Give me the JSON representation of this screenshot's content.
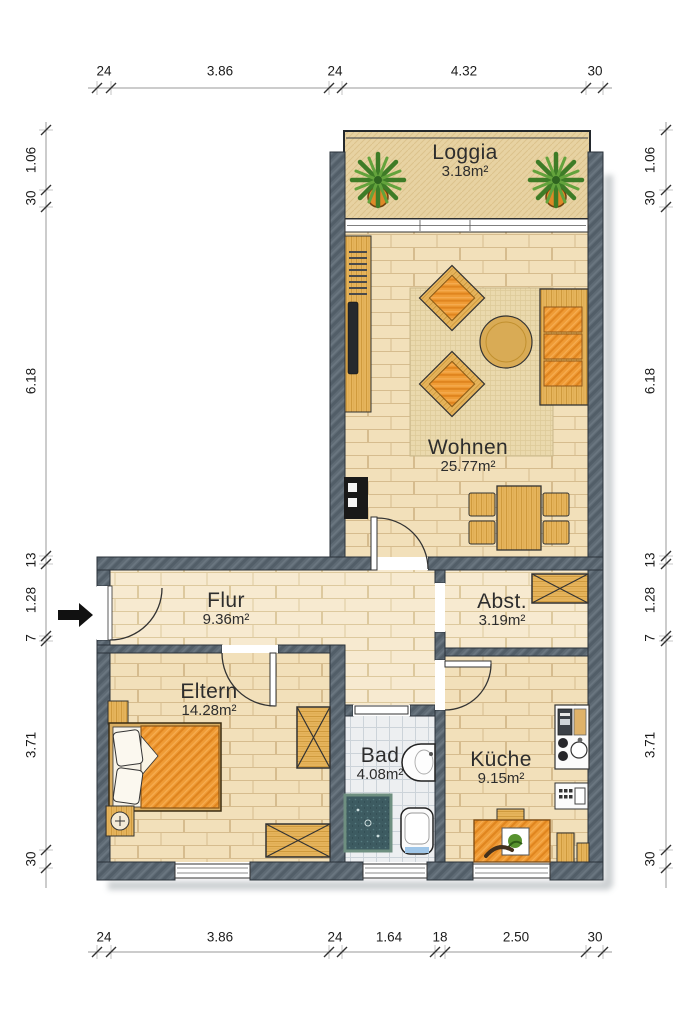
{
  "rooms": {
    "loggia": {
      "name": "Loggia",
      "area": "3.18m²"
    },
    "wohnen": {
      "name": "Wohnen",
      "area": "25.77m²"
    },
    "flur": {
      "name": "Flur",
      "area": "9.36m²"
    },
    "abst": {
      "name": "Abst.",
      "area": "3.19m²"
    },
    "eltern": {
      "name": "Eltern",
      "area": "14.28m²"
    },
    "bad": {
      "name": "Bad",
      "area": "4.08m²"
    },
    "kueche": {
      "name": "Küche",
      "area": "9.15m²"
    }
  },
  "dimensions": {
    "top": [
      "24",
      "3.86",
      "24",
      "4.32",
      "30"
    ],
    "bottom": [
      "24",
      "3.86",
      "24",
      "1.64",
      "18",
      "2.50",
      "30"
    ],
    "left": [
      "1.06",
      "30",
      "6.18",
      "13",
      "1.28",
      "7",
      "3.71",
      "30"
    ],
    "right": [
      "1.06",
      "30",
      "6.18",
      "13",
      "1.28",
      "7",
      "3.71",
      "30"
    ]
  },
  "colors": {
    "wall": "#5e6a74",
    "floor_tan": "#f2e0ba",
    "floor_hall": "#f7ead0",
    "bath_tile": "#edeff1",
    "furniture_orange": "#ef9b35",
    "furniture_wood": "#e6b45c",
    "outline": "#2a323a"
  }
}
